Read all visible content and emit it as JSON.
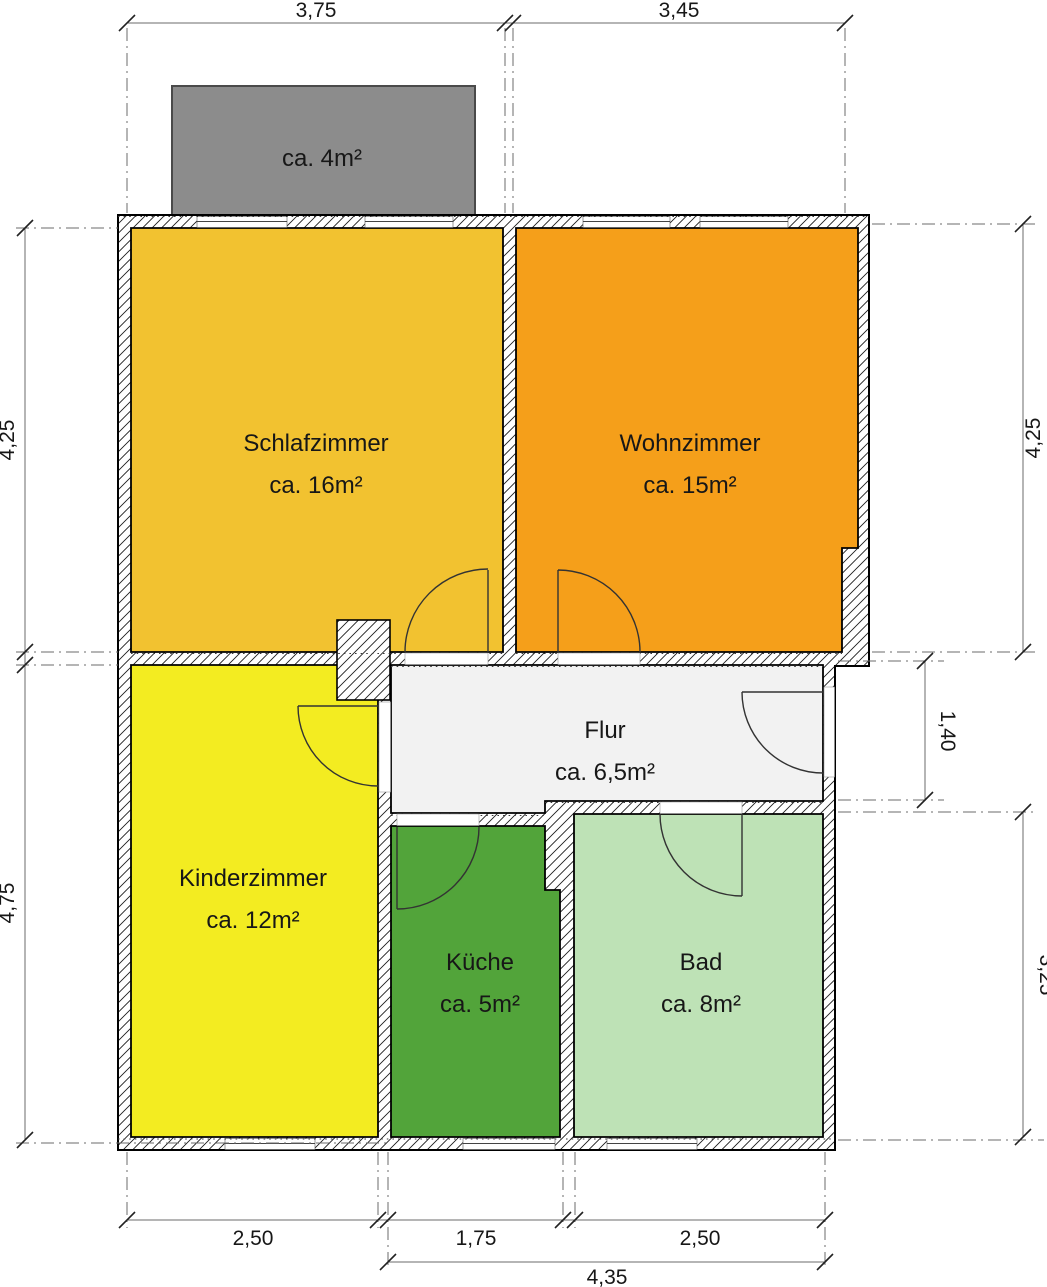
{
  "balcony": {
    "label": "ca. 4m²",
    "fill": "#8c8c8c"
  },
  "rooms": [
    {
      "key": "schlafzimmer",
      "name": "Schlafzimmer",
      "area": "ca. 16m²",
      "fill": "#f2c230"
    },
    {
      "key": "wohnzimmer",
      "name": "Wohnzimmer",
      "area": "ca. 15m²",
      "fill": "#f59f1a"
    },
    {
      "key": "kinderzimmer",
      "name": "Kinderzimmer",
      "area": "ca. 12m²",
      "fill": "#f3ec21"
    },
    {
      "key": "flur",
      "name": "Flur",
      "area": "ca. 6,5m²",
      "fill": "#f2f2f2"
    },
    {
      "key": "kueche",
      "name": "Küche",
      "area": "ca. 5m²",
      "fill": "#52a43a"
    },
    {
      "key": "bad",
      "name": "Bad",
      "area": "ca. 8m²",
      "fill": "#bee2b6"
    }
  ],
  "dimensions": {
    "top": [
      "3,75",
      "3,45"
    ],
    "left": [
      "4,25",
      "4,75"
    ],
    "right": [
      "4,25",
      "1,40",
      "3,25"
    ],
    "bottom": [
      "2,50",
      "1,75",
      "2,50",
      "4,35"
    ]
  }
}
